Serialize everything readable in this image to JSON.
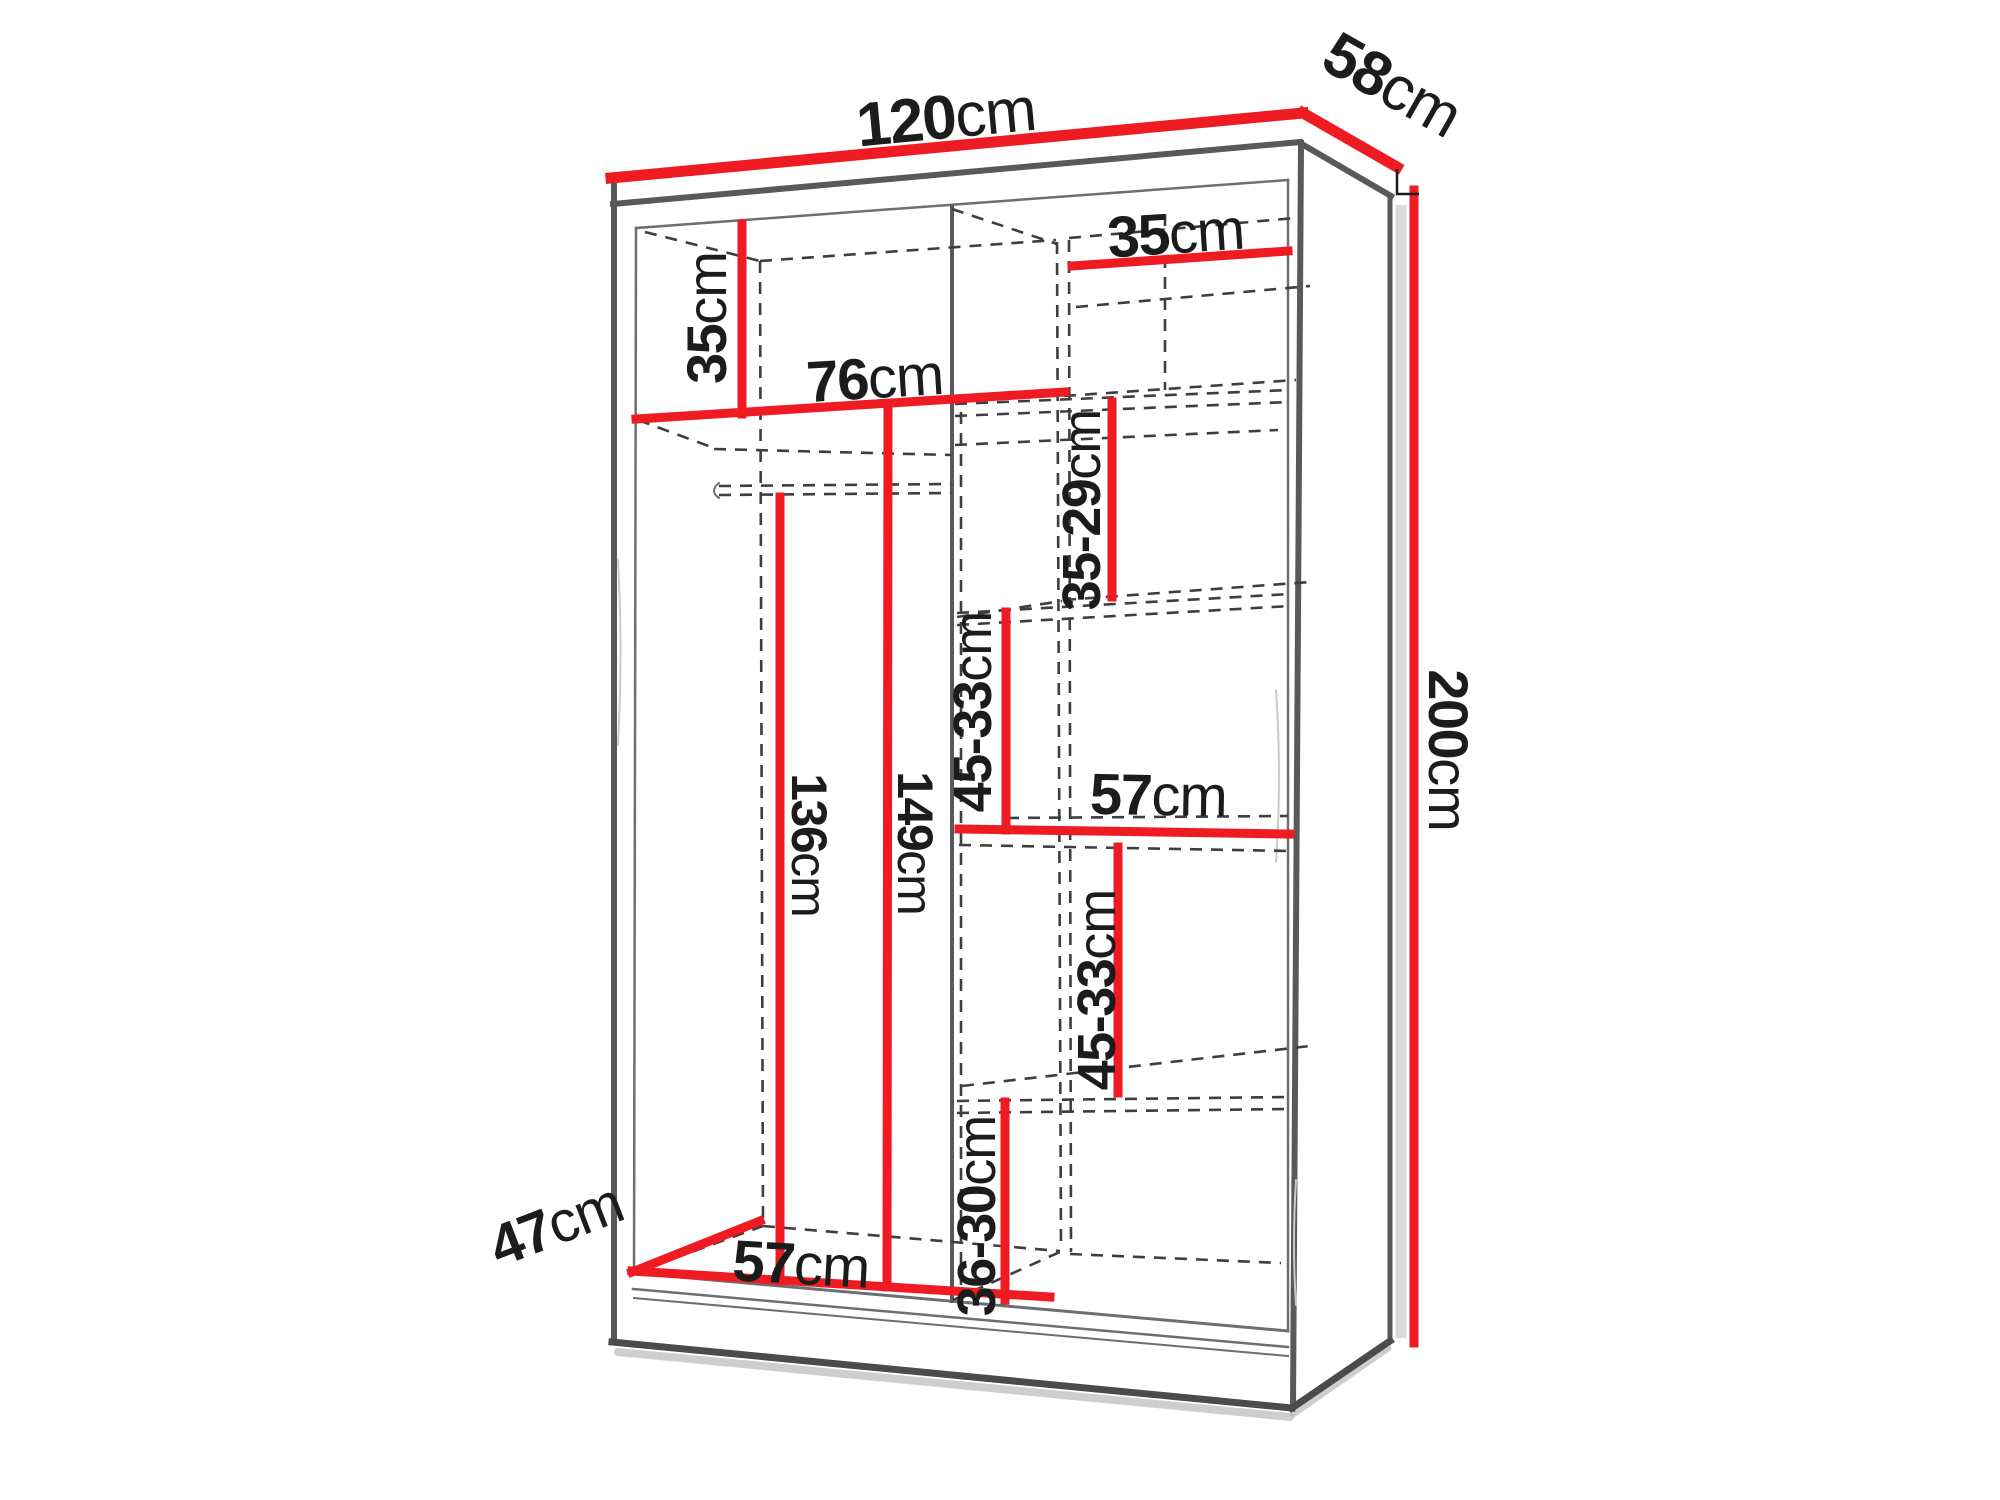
{
  "diagram": {
    "type": "furniture-dimension-diagram",
    "subject": "wardrobe interior with shelves and hanging rail, isometric line drawing",
    "unit": "cm",
    "overall": {
      "width": "120",
      "depth": "58",
      "height": "200"
    },
    "labels": [
      {
        "name": "overall-width",
        "value": "120",
        "unit": "cm"
      },
      {
        "name": "overall-depth",
        "value": "58",
        "unit": "cm"
      },
      {
        "name": "overall-height",
        "value": "200",
        "unit": "cm"
      },
      {
        "name": "left-top-section-height",
        "value": "35",
        "unit": "cm"
      },
      {
        "name": "right-top-shelf-width",
        "value": "35",
        "unit": "cm"
      },
      {
        "name": "left-shelf-width",
        "value": "76",
        "unit": "cm"
      },
      {
        "name": "right-upper-section-height",
        "value": "35-29",
        "unit": "cm"
      },
      {
        "name": "right-second-section-height",
        "value": "45-33",
        "unit": "cm"
      },
      {
        "name": "right-middle-shelf-width",
        "value": "57",
        "unit": "cm"
      },
      {
        "name": "right-third-section-height",
        "value": "45-33",
        "unit": "cm"
      },
      {
        "name": "hanging-space-height",
        "value": "136",
        "unit": "cm"
      },
      {
        "name": "left-interior-height",
        "value": "149",
        "unit": "cm"
      },
      {
        "name": "right-bottom-section-height",
        "value": "36-30",
        "unit": "cm"
      },
      {
        "name": "interior-depth",
        "value": "47",
        "unit": "cm"
      },
      {
        "name": "left-interior-width",
        "value": "57",
        "unit": "cm"
      }
    ]
  },
  "colors": {
    "accent": "#ee1b22",
    "line": "#58595b",
    "line2": "#6d6e71",
    "dashc": "#3d3e40",
    "ink": "#1c1c1c",
    "bg": "#ffffff"
  }
}
